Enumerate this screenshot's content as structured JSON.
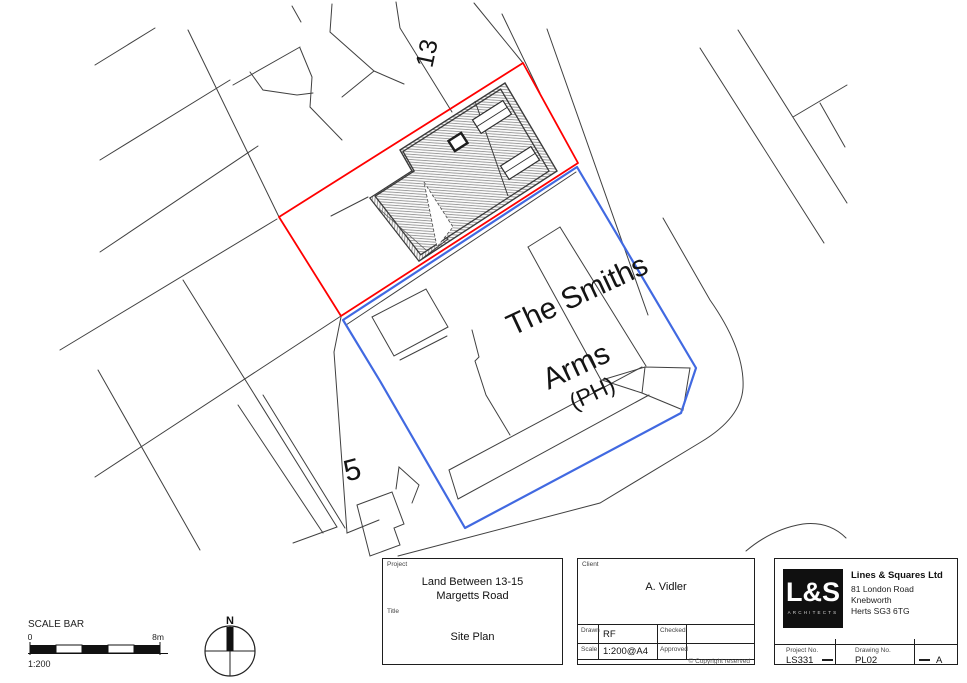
{
  "map": {
    "labels": {
      "plot_13": "13",
      "plot_5": "5",
      "pub_line1": "The Smiths",
      "pub_line2": "Arms",
      "pub_line3": "(PH)"
    },
    "colors": {
      "site_boundary": "#ff0000",
      "ownership_boundary": "#4169e1",
      "plot_lines": "#404040"
    }
  },
  "scale_bar": {
    "title": "SCALE BAR",
    "start": "0",
    "end": "8m",
    "ratio": "1:200"
  },
  "north_arrow": {
    "label": "N"
  },
  "title_block": {
    "project": {
      "label": "Project",
      "value_line1": "Land Between 13-15",
      "value_line2": "Margetts Road"
    },
    "title": {
      "label": "Title",
      "value": "Site Plan"
    },
    "client": {
      "label": "Client",
      "value": "A. Vidler"
    },
    "drawn": {
      "label": "Drawn",
      "value": "RF"
    },
    "checked": {
      "label": "Checked",
      "value": ""
    },
    "scale": {
      "label": "Scale",
      "value": "1:200@A4"
    },
    "approved": {
      "label": "Approved",
      "value": ""
    },
    "copyright_symbol": "©",
    "copyright": "Copyright reserved",
    "company": {
      "logo": "L&S",
      "logo_sub": "ARCHITECTS",
      "name": "Lines & Squares Ltd",
      "address_line1": "81 London Road",
      "address_line2": "Knebworth",
      "address_line3": "Herts SG3 6TG"
    },
    "project_no": {
      "label": "Project No.",
      "value": "LS331"
    },
    "drawing_no": {
      "label": "Drawing No.",
      "value": "PL02"
    },
    "revision": "A"
  }
}
